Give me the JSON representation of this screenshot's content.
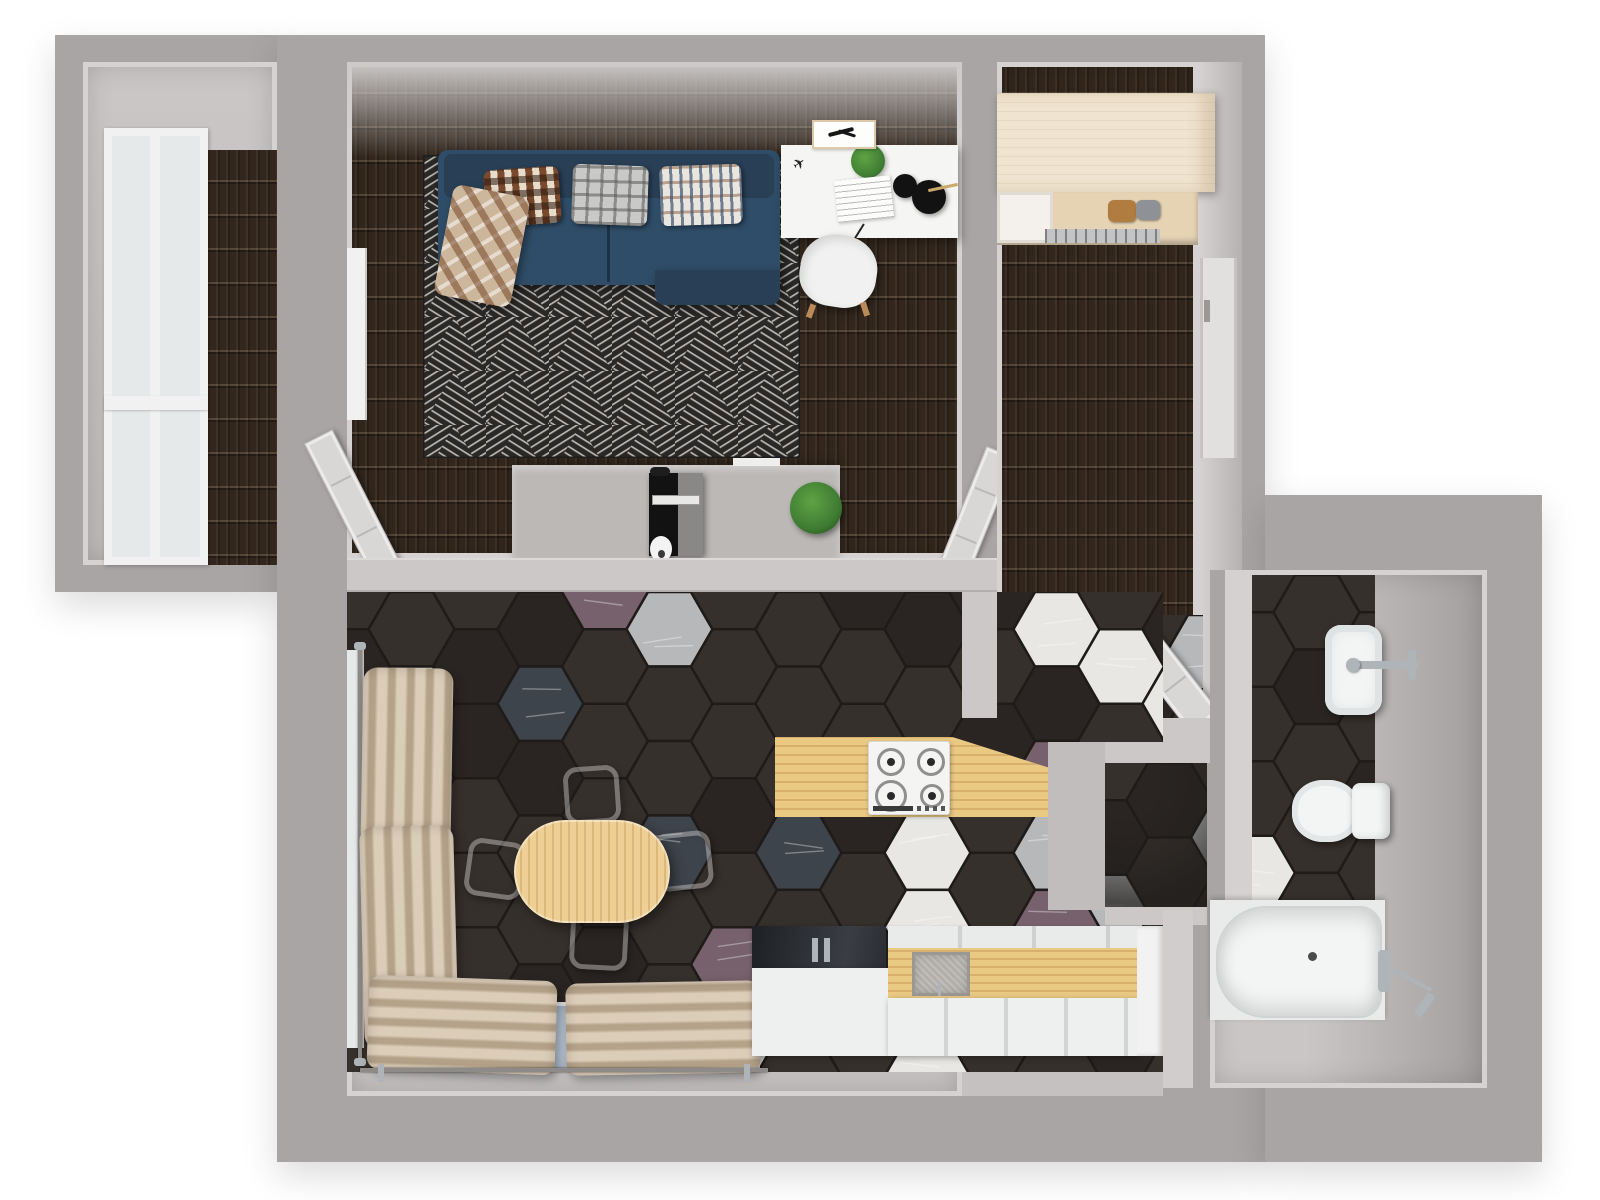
{
  "scene": {
    "description": "3D rendered top-down floor plan of a one-bedroom apartment",
    "view": "top-down render, no visible text labels"
  },
  "colors": {
    "page_bg": "#ffffff",
    "wall": "#a9a5a4",
    "wall_bright": "#cbc8c7",
    "wall_face_edge": "#d5d2d1",
    "floor_wood": "#33271d",
    "room_gray": "#c4c1c0",
    "rug_base": "#2b2927",
    "rug_line": "#c9c6c2",
    "sofa": "#2f4d68",
    "sofa_dark": "#283f55",
    "throw_beige": "#cdb79c",
    "desk_white": "#f5f5f4",
    "cabinet_white": "#eef0ef",
    "chair_white": "#f0f1f0",
    "chair_wood": "#b98a5a",
    "console_gray": "#bcb8b6",
    "tv_black": "#121212",
    "tv_gray": "#8a8887",
    "plant_green": "#3f7d33",
    "plant_light": "#5ea344",
    "wardrobe_cream": "#f0e4d0",
    "wardrobe_edge": "#dcc9a9",
    "shelf_wood": "#e6d3b4",
    "door_leaf": "#d9d7d6",
    "door_line": "#bbb8b7",
    "curtain": "#dccdb9",
    "curtain_shade": "#b4a289",
    "table_wood": "#eed096",
    "table_grain": "#d9b878",
    "counter_wood": "#eac983",
    "stove_white": "#f4f4f3",
    "burner_ring": "#8f8f8f",
    "burner_center": "#2a2a2a",
    "sink_gray": "#b2afab",
    "dark_glass": "#22262a",
    "glass_blue": "#b6c4d2",
    "glass_pale": "#e6e9e9",
    "window_frame": "#f0f1f0",
    "bath_white": "#f3f5f5",
    "chrome": "#aeb4b8",
    "chrome_dark": "#8d8a88",
    "hex_grout": "#1e1b19"
  },
  "hex_floor": {
    "tile_radius": 43,
    "palette": [
      {
        "name": "charcoal",
        "color": "#36302c",
        "weight": 46
      },
      {
        "name": "charcoal-dark",
        "color": "#2a2523",
        "weight": 18
      },
      {
        "name": "white",
        "color": "#e8e7e4",
        "weight": 9
      },
      {
        "name": "marble-light",
        "color": "#b7b8b9",
        "weight": 10
      },
      {
        "name": "marble-slate",
        "color": "#3e444c",
        "weight": 11
      },
      {
        "name": "marble-mauve",
        "color": "#77616c",
        "weight": 6
      }
    ],
    "regions": {
      "dining": 7,
      "closet": 3,
      "bath": 11,
      "hall_patch": 5
    }
  },
  "rooms": {
    "balcony": {
      "floor": "dark wood planks",
      "furniture": [
        "full-height window"
      ]
    },
    "living_room": {
      "floor": "dark wood planks",
      "furniture": [
        "blue sofa",
        "three patterned pillows",
        "plaid throw",
        "triangle pattern rug",
        "white desk",
        "desk plant",
        "black desk lamp",
        "papers",
        "wall picture",
        "white desk chair",
        "gray tv console",
        "tv",
        "console plant",
        "two open doors"
      ]
    },
    "hallway": {
      "floor": "dark wood planks",
      "furniture": [
        "cream wardrobe",
        "shoe shelf",
        "entrance door",
        "two open doors",
        "dark tile doormat"
      ]
    },
    "kitchen_dining": {
      "floor": "hexagon tiles",
      "furniture": [
        "oval wood dining table",
        "four beige chairs",
        "left window with curtains",
        "bottom window with curtains",
        "gas hob counter",
        "dark glass counter",
        "sink counter",
        "white base cabinets"
      ]
    },
    "storage_closet": {
      "floor": "hexagon tiles",
      "furniture": []
    },
    "bathroom": {
      "floor": "hexagon tiles and screed",
      "furniture": [
        "washbasin with faucet",
        "toilet",
        "bathtub",
        "shower mixer"
      ]
    }
  }
}
